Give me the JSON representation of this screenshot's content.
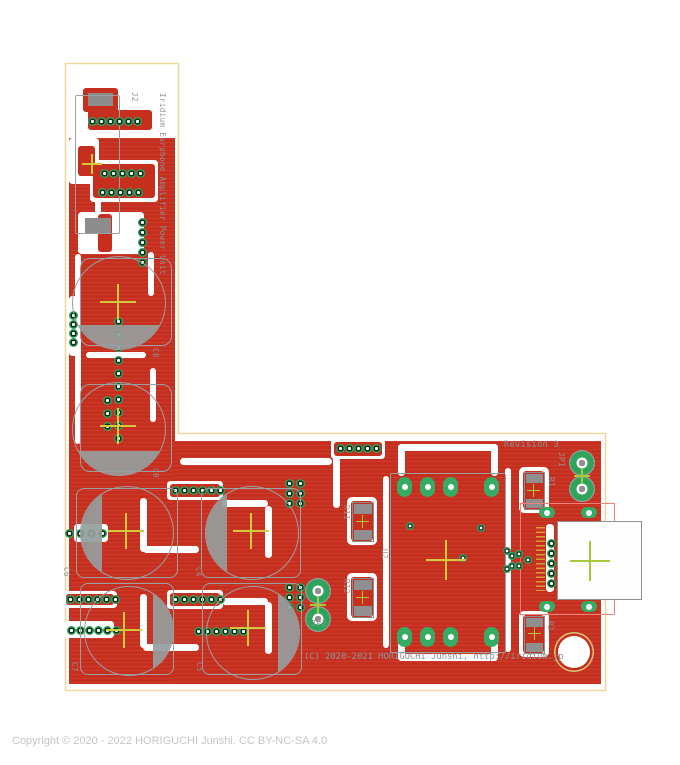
{
  "silkscreen": {
    "title": "Iridium Earphone Amplifier Power Unit",
    "revision": "Revision 3",
    "copyright": "(C) 2020-2021 HORIGUCHI Junshi, http://iridium.jp"
  },
  "refdes": {
    "j2": "J2",
    "c4": "C4",
    "c5": "C5",
    "c6": "C6",
    "c7": "C7",
    "c8": "C8",
    "c9": "C9",
    "r1": "R1",
    "r2": "R2",
    "r11": "R11",
    "r12": "R12",
    "u2": "U2",
    "jp1": "JP1",
    "jp2": "JP2"
  },
  "footer": {
    "copyright": "Copyright © 2020 - 2022 HORIGUCHI Junshi. CC BY-NC-SA 4.0"
  },
  "colors": {
    "copper_red": "#c62e1e",
    "pad_green": "#2fa35c",
    "silkscreen_gray": "#8f9496",
    "board_edge_yellow": "#f0d79e",
    "crosshair_yellow": "#d4c83c",
    "crosshair_green": "#a8c838",
    "courtyard_pink": "#ef8080",
    "footer_gray": "#c5c5c5"
  }
}
